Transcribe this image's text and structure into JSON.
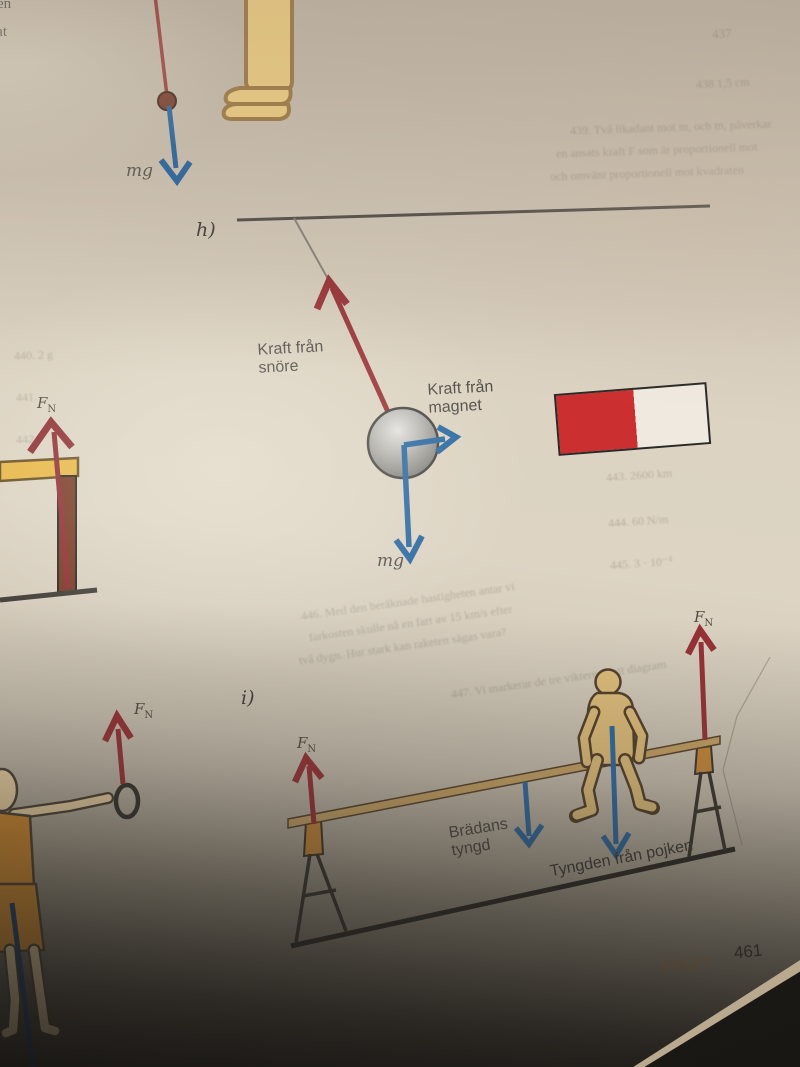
{
  "page": {
    "footer_label": "FACIT",
    "page_number": "461",
    "corner_fragment_line1": "ren",
    "corner_fragment_line2": "lat"
  },
  "fn": {
    "f": "F",
    "sub": "N"
  },
  "labels_top": {
    "weight": "mg"
  },
  "labels_h": {
    "section": "h)",
    "string_force": "Kraft från\nsnöre",
    "magnet_force": "Kraft från\nmagnet",
    "weight": "mg"
  },
  "labels_i": {
    "section": "i)",
    "board_weight": "Brädans\ntyngd",
    "boy_weight": "Tyngden från pojken"
  },
  "colors": {
    "red_arrow": "#983338",
    "blue_arrow": "#2f6ba3",
    "magnet_red": "#cc2f30",
    "magnet_white": "#efe9df",
    "facit_orange": "#c08040",
    "plank_tan": "#c8a365",
    "figure_skin": "#e2c07c",
    "clothes_orange": "#d08a2e",
    "page_beige": "#d8cfc0"
  },
  "ghost_texts": [
    {
      "text": "437",
      "x": 712,
      "y": 26,
      "size": 13,
      "rot": -3
    },
    {
      "text": "438    1,5 cm",
      "x": 696,
      "y": 76,
      "size": 12,
      "rot": -3
    },
    {
      "text": "439.  Två likadant mot m, och m, påverkar",
      "x": 570,
      "y": 120,
      "size": 12,
      "rot": -2
    },
    {
      "text": "en ansats kraft F som är proportionell mot",
      "x": 556,
      "y": 143,
      "size": 12,
      "rot": -2
    },
    {
      "text": "och omvänt proportionell mot kvadraten",
      "x": 550,
      "y": 166,
      "size": 12,
      "rot": -2
    },
    {
      "text": "440.  2 g",
      "x": 14,
      "y": 348,
      "size": 12,
      "rot": -2
    },
    {
      "text": "441.",
      "x": 16,
      "y": 390,
      "size": 12,
      "rot": -2
    },
    {
      "text": "442.",
      "x": 16,
      "y": 432,
      "size": 12,
      "rot": -2
    },
    {
      "text": "443.   2600 km",
      "x": 606,
      "y": 468,
      "size": 12,
      "rot": -4
    },
    {
      "text": "444.   60 N/m",
      "x": 608,
      "y": 514,
      "size": 12,
      "rot": -4
    },
    {
      "text": "445.   3 · 10⁻⁴",
      "x": 610,
      "y": 556,
      "size": 12,
      "rot": -4
    },
    {
      "text": "446.  Med den beräknade hastigheten antar vi",
      "x": 300,
      "y": 594,
      "size": 12,
      "rot": -8
    },
    {
      "text": "farkosten skulle nå en fart av 15 km/s efter",
      "x": 308,
      "y": 616,
      "size": 12,
      "rot": -8
    },
    {
      "text": "två dygn. Hur stark kan raketen sägas vara?",
      "x": 298,
      "y": 639,
      "size": 12,
      "rot": -8
    },
    {
      "text": "447.   Vi markerar de tre vikterna i ett diagram",
      "x": 450,
      "y": 672,
      "size": 12,
      "rot": -8
    }
  ]
}
